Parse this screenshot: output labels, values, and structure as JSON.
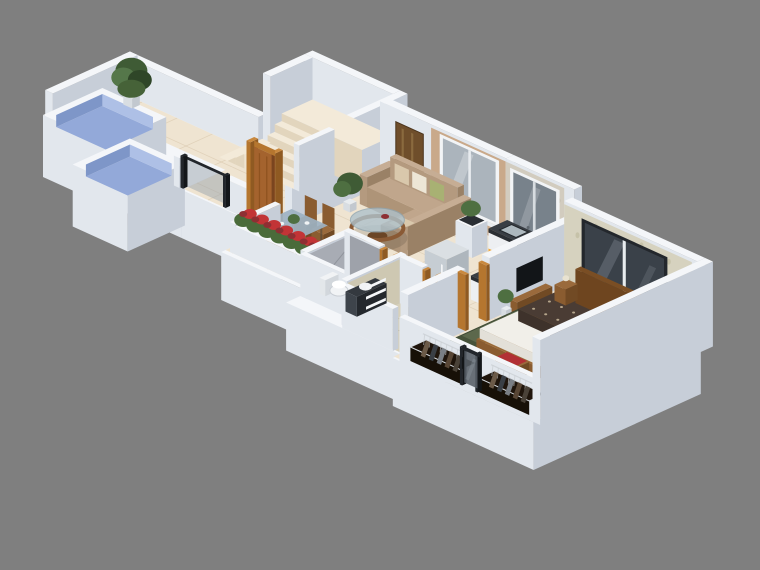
{
  "scene": {
    "kind": "3d-isometric-floor-plan-render",
    "background": "#7F7F7F",
    "view": {
      "width": 760,
      "height": 570,
      "projection": "isometric"
    }
  },
  "colors": {
    "background": "#7F7F7F",
    "wallTop": "#F4F6F9",
    "wallFront": "#E2E7ED",
    "wallSide": "#C7CED8",
    "floorTile": "#EFE4D1",
    "grout": "#D9C8AD",
    "landing": "#F3EAD9",
    "stepFront": "#E2D5BD",
    "tankBlue": "#93A9D9",
    "tankBlueLight": "#AEC0E6",
    "tankBlueDark": "#7E96C8",
    "wood": "#9A6A3C",
    "woodFront": "#8A5C30",
    "woodDark": "#714A24",
    "door": "#A4632E",
    "doorDark": "#7A451F",
    "doorFrame": "#B5762F",
    "doorFrameLight": "#C9893F",
    "sofaTop": "#C0A68C",
    "sofaFront": "#AE9478",
    "sofaSide": "#97805F",
    "sofaArmTop": "#C6AD94",
    "sofaArmFront": "#B49A7F",
    "sofaArmSide": "#9A8166",
    "cushionBeige": "#D9C8AC",
    "cushionWhite": "#EDE6D6",
    "cushionGreen": "#A8B173",
    "tanWall": "#C9A98A",
    "art": "#6F4E2B",
    "artLight": "#8A6A3F",
    "winFrame": "#F2F4F6",
    "winGlassLight": "#ABB4BC",
    "winGlassMid": "#78828B",
    "winGlassDark": "#3A4149",
    "winFrameDark": "#23272C",
    "sill": "#E8ECEF",
    "stone": "#D2CCBF",
    "stoneDot": "#B9B2A2",
    "counterTop": "#393E44",
    "counterEdge": "#2A2E33",
    "cabinet": "#EDEFF2",
    "glow": "#F0A83C",
    "sinkSteel": "#ADB8BE",
    "cooktop": "#1E2226",
    "burner": "#3A4046",
    "fridgeTop": "#DADFE3",
    "fridgeFront": "#C6CDD3",
    "fridgeSide": "#AEB6BD",
    "marbleGrayFloor": "#A2A6AE",
    "marbleGrayWall": "#A8ACB4",
    "marbleVein": "#83878F",
    "marbleBeigeFloor": "#D8D1BB",
    "marbleBeigeWall": "#CEC8B2",
    "marbleBeigeVein": "#BAB096",
    "ceramic": "#F1F3F5",
    "wallpaper": "#D6D2BF",
    "wallpaperDot": "#C3BFA4",
    "rug": "#5C684C",
    "rugDark": "#46523A",
    "sheet": "#F1EFE9",
    "sheetSide": "#E3E0D8",
    "sheetDark": "#CFCBC0",
    "duvetTop": "#4A3C34",
    "duvetFront": "#3E322B",
    "duvetSide": "#332922",
    "duvetDot": "#C9B89C",
    "pillow": "#41362E",
    "pillowDark": "#38302A",
    "headboardTop": "#7A4E24",
    "headboard": "#6E451F",
    "headboardSide": "#5A3718",
    "closet": "#1F150C",
    "closetFront": "#171007",
    "hanger": "#C6CBD0",
    "railFrame": "#22262B",
    "railGlass": "#9AA4AE",
    "railGlassDark": "#565E66",
    "leafDark": "#3F5B35",
    "leaf": "#55774A",
    "leafDeep": "#2F4628",
    "leafMid": "#4E6F41",
    "flowerRed": "#C23436",
    "flowerDark": "#8E2F33",
    "glassTable": "#AFC2CC",
    "glassDining": "#9DB2C2",
    "glassEdge": "#7E95A6",
    "tableRing": "#8A5A35",
    "legWood": "#55493A",
    "benchRed": "#B23034",
    "tv": "#121518",
    "shadow": "#000000"
  },
  "rooms": [
    {
      "name": "terrace",
      "objects": [
        "water-tank",
        "water-tank",
        "potted-plant",
        "glass-railing",
        "tiled-floor"
      ]
    },
    {
      "name": "staircase",
      "objects": [
        "landing",
        "steps",
        "white-walls",
        "balustrade"
      ]
    },
    {
      "name": "entrance",
      "objects": [
        "wooden-door",
        "glass-railing",
        "low-parapet"
      ]
    },
    {
      "name": "living-room",
      "objects": [
        "l-shaped-sofa",
        "throw-pillows",
        "round-glass-coffee-table",
        "wall-art",
        "accent-wall",
        "window",
        "planter-flowers",
        "console",
        "potted-plant"
      ]
    },
    {
      "name": "dining-area",
      "objects": [
        "glass-dining-table",
        "wooden-chairs",
        "centerpiece-plant"
      ]
    },
    {
      "name": "kitchen",
      "objects": [
        "l-shaped-counter",
        "sink",
        "cooktop",
        "refrigerator",
        "window",
        "under-cabinet-lighting"
      ]
    },
    {
      "name": "bathroom-gray",
      "objects": [
        "toilet",
        "vanity-counter",
        "basin",
        "marble-tiles"
      ]
    },
    {
      "name": "bathroom-beige",
      "objects": [
        "towel-ladder",
        "marble-tiles",
        "door-frames"
      ]
    },
    {
      "name": "bedroom",
      "objects": [
        "double-bed",
        "patterned-duvet",
        "white-sheet",
        "pillows",
        "headboard",
        "nightstands",
        "bench",
        "green-rug",
        "open-wardrobes",
        "clothes-hangers",
        "glass-rail-window",
        "tv-panel",
        "window",
        "wallpaper-accent-wall"
      ]
    }
  ]
}
